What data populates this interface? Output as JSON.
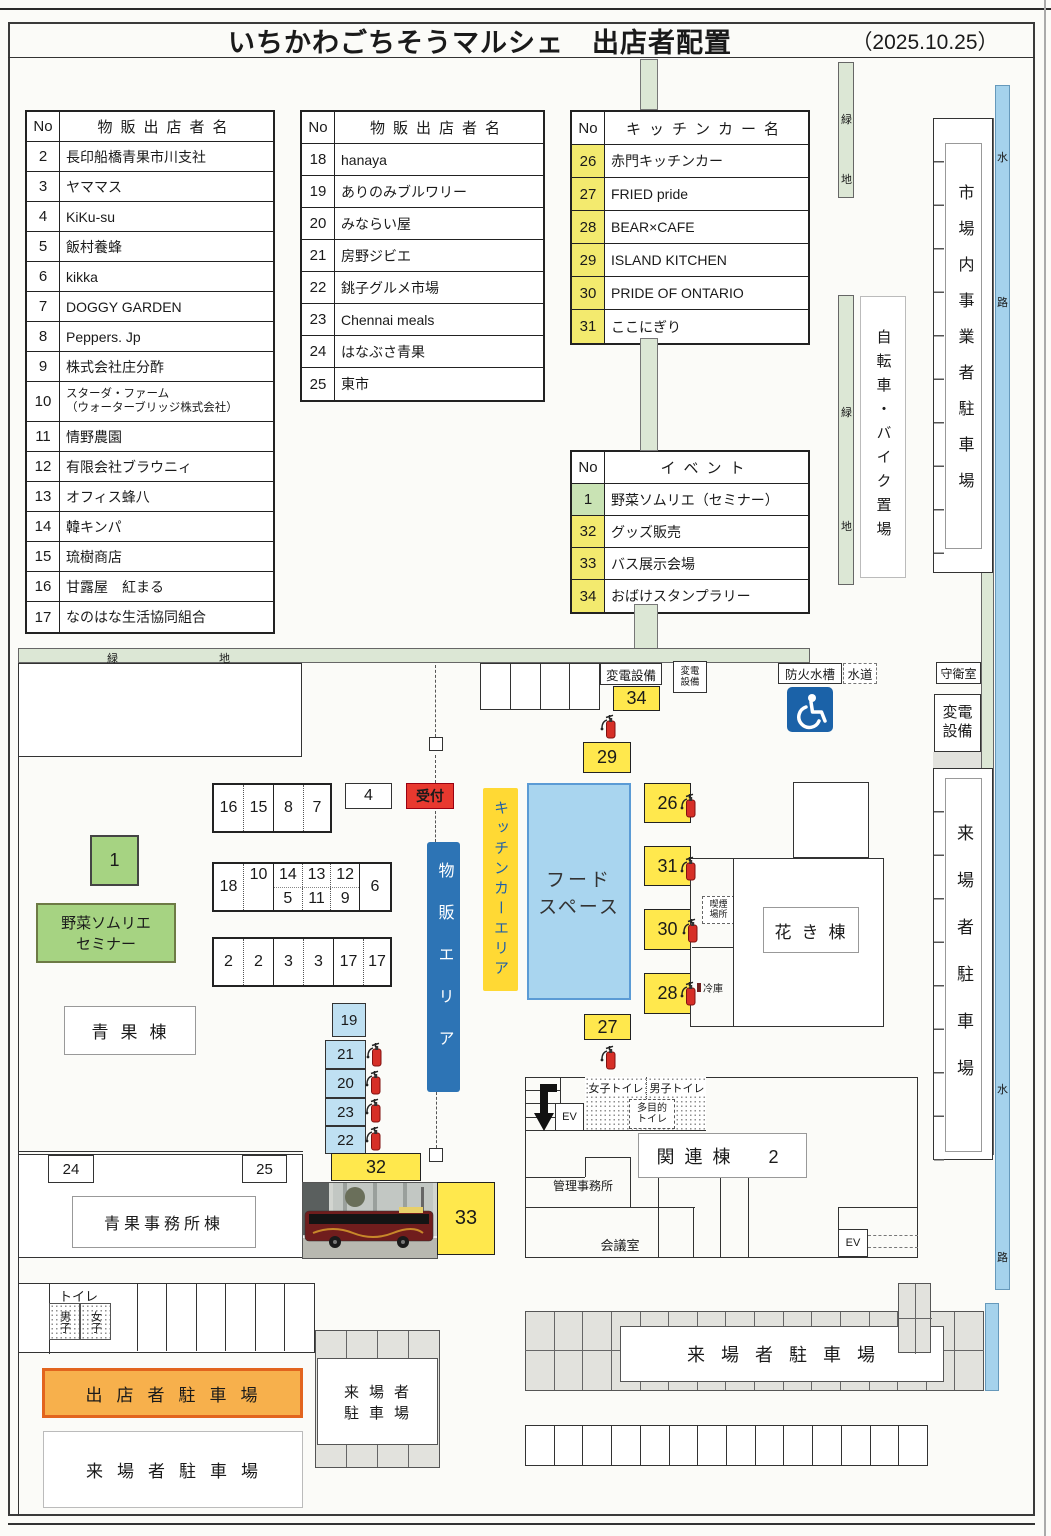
{
  "title": {
    "text": "いちかわごちそうマルシェ　出店者配置",
    "date": "（2025.10.25）"
  },
  "tables": {
    "no_header": "No",
    "goods1": {
      "header": "物販出店者名",
      "rows": [
        {
          "no": "2",
          "name": "長印船橋青果市川支社"
        },
        {
          "no": "3",
          "name": "ヤママス"
        },
        {
          "no": "4",
          "name": "KiKu-su"
        },
        {
          "no": "5",
          "name": "飯村養蜂"
        },
        {
          "no": "6",
          "name": "kikka"
        },
        {
          "no": "7",
          "name": "DOGGY GARDEN"
        },
        {
          "no": "8",
          "name": "Peppers. Jp"
        },
        {
          "no": "9",
          "name": "株式会社庄分酢"
        },
        {
          "no": "10",
          "name": "スターダ・ファーム\n（ウォーターブリッジ株式会社）"
        },
        {
          "no": "11",
          "name": "情野農園"
        },
        {
          "no": "12",
          "name": "有限会社ブラウニィ"
        },
        {
          "no": "13",
          "name": "オフィス蜂八"
        },
        {
          "no": "14",
          "name": "韓キンパ"
        },
        {
          "no": "15",
          "name": "琉樹商店"
        },
        {
          "no": "16",
          "name": "甘露屋　紅まる"
        },
        {
          "no": "17",
          "name": "なのはな生活協同組合"
        }
      ]
    },
    "goods2": {
      "header": "物販出店者名",
      "rows": [
        {
          "no": "18",
          "name": "hanaya"
        },
        {
          "no": "19",
          "name": "ありのみブルワリー"
        },
        {
          "no": "20",
          "name": "みならい屋"
        },
        {
          "no": "21",
          "name": "房野ジビエ"
        },
        {
          "no": "22",
          "name": "銚子グルメ市場"
        },
        {
          "no": "23",
          "name": "Chennai meals"
        },
        {
          "no": "24",
          "name": "はなぶさ青果"
        },
        {
          "no": "25",
          "name": "東市"
        }
      ]
    },
    "kitchen": {
      "header": "キッチンカー名",
      "rows": [
        {
          "no": "26",
          "name": "赤門キッチンカー",
          "c": "y"
        },
        {
          "no": "27",
          "name": "FRIED pride",
          "c": "y"
        },
        {
          "no": "28",
          "name": "BEAR×CAFE",
          "c": "y"
        },
        {
          "no": "29",
          "name": "ISLAND KITCHEN",
          "c": "y"
        },
        {
          "no": "30",
          "name": "PRIDE OF ONTARIO",
          "c": "y"
        },
        {
          "no": "31",
          "name": "ここにぎり",
          "c": "y"
        }
      ]
    },
    "event": {
      "header": "イベント",
      "rows": [
        {
          "no": "1",
          "name": "野菜ソムリエ（セミナー）",
          "c": "g"
        },
        {
          "no": "32",
          "name": "グッズ販売",
          "c": "y"
        },
        {
          "no": "33",
          "name": "バス展示会場",
          "c": "y"
        },
        {
          "no": "34",
          "name": "おばけスタンプラリー",
          "c": "y"
        }
      ]
    }
  },
  "map": {
    "chars": {
      "green": "緑",
      "ground": "地",
      "water": "水",
      "way": "路"
    },
    "bicycle_parking": "自転車・バイク置場",
    "market_parking": "市場内事業者駐車場",
    "guard_room": "守衛室",
    "substation": "変電設備",
    "fire_water_tank": "防火水槽",
    "water_supply": "水道",
    "visitor_parking": "来場者駐車場",
    "visitor_parking_lines": [
      "来場者",
      "駐車場"
    ],
    "vendor_parking": "出店者駐車場",
    "reception": "受付",
    "goods_area": "物販エリア",
    "kitchen_area": "キッチンカーエリア",
    "food_space_lines": [
      "フード",
      "スペース"
    ],
    "flower_bldg": "花き棟",
    "seika_bldg": "青果棟",
    "seika_office": "青果事務所棟",
    "smoking_lines": [
      "喫煙",
      "場所"
    ],
    "cold_storage": "冷庫",
    "seminar_no": "1",
    "seminar_lines": [
      "野菜ソムリエ",
      "セミナー"
    ],
    "kanren_bldg": "関連棟　2",
    "admin_office": "管理事務所",
    "meeting_room": "会議室",
    "elevator": "EV",
    "toilet": "トイレ",
    "men": "男子",
    "women": "女子",
    "w_toilet": "女子トイレ",
    "m_toilet": "男子トイレ",
    "multi_toilet_lines": [
      "多目的",
      "トイレ"
    ],
    "booths": {
      "row1": [
        "16",
        "15",
        "8",
        "7"
      ],
      "box4": "4",
      "row2": {
        "c18": "18",
        "c10": "10",
        "c14": "14",
        "c5": "5",
        "c13": "13",
        "c11": "11",
        "c12": "12",
        "c9": "9",
        "c6": "6"
      },
      "row3": [
        "2",
        "2",
        "3",
        "3",
        "17",
        "17"
      ],
      "blue": [
        "19",
        "21",
        "20",
        "23",
        "22"
      ]
    },
    "spots": {
      "s24": "24",
      "s25": "25",
      "s26": "26",
      "s27": "27",
      "s28": "28",
      "s29": "29",
      "s30": "30",
      "s31": "31",
      "s32": "32",
      "s33": "33",
      "s34": "34"
    }
  },
  "colors": {
    "yellow": "#ffe84d",
    "tableYellow": "#f3ea6e",
    "tableGreen": "#c9e3b4",
    "blue": "#2d74b5",
    "kitchenYellow": "#ffd934",
    "foodBlue": "#a9d5ef",
    "foodBorder": "#5b9bd5",
    "lightBlue": "#bfe0f2",
    "greenBox": "#a6d382",
    "greenStrip": "#dce7d5",
    "waterBlue": "#a5d2ec",
    "orange": "#f7b04c",
    "orangeBorder": "#e2641e",
    "red": "#e8392f",
    "grayPark": "#e2e2dd",
    "extRed": "#d62f27",
    "wcBlue": "#1b62a8"
  }
}
